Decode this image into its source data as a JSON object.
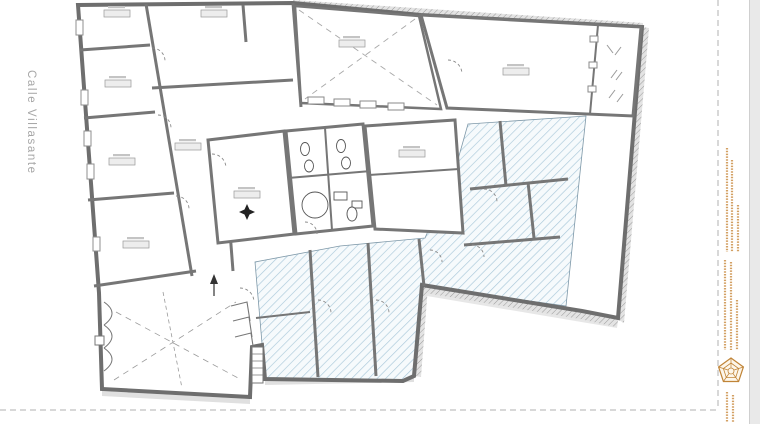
{
  "sheet": {
    "background": "#ffffff",
    "edge_strip_color": "#e9e9e9",
    "trim_dash_color": "#b0b0b0"
  },
  "street_label": {
    "text": "Calle Villasante",
    "color": "#a6a6a6"
  },
  "plan": {
    "type": "architectural-floor-plan",
    "wall_color": "#6e6e6e",
    "interior_wall_color": "#767676",
    "blue_hatch_line_color": "#a9c8da",
    "blue_hatch_background": "#f6fafc",
    "party_wall_hatch_color": "#9a9a9a",
    "door_arc_color": "#8a8a8a",
    "room_label_boxes_legible": false
  },
  "right_margin": {
    "micro_text_color": "#cf9654",
    "micro_text_legible": false
  },
  "stamp": {
    "shape": "pentagon-rosette",
    "color": "#c08437",
    "fill": "#fdf6ea",
    "text_legible": false
  }
}
